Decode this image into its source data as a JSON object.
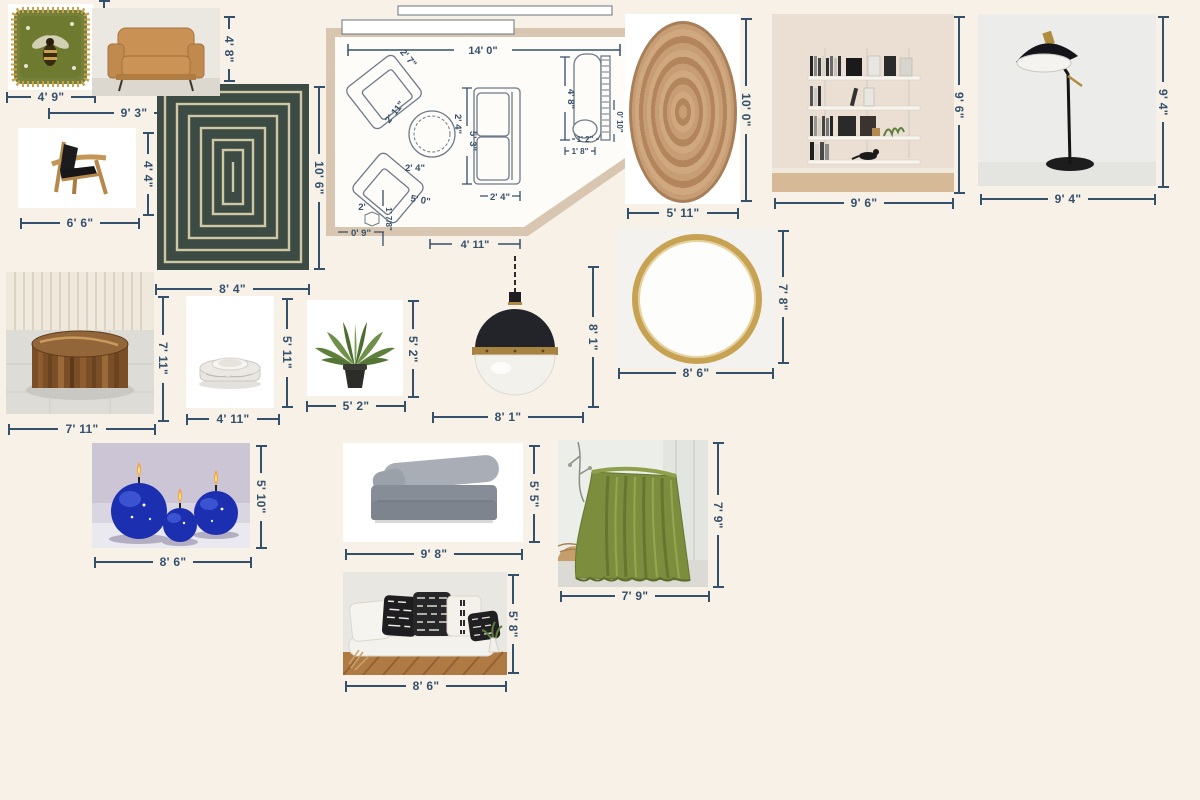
{
  "colors": {
    "background": "#f7f1e8",
    "dimension": "#35506b",
    "plan_wall": "#d8c6b1"
  },
  "items": {
    "bee_pillow": {
      "w": "4' 9\"",
      "h": "4' 9\""
    },
    "leather_armchair": {
      "w": "9' 3\"",
      "h": "4' 8\""
    },
    "sling_chair": {
      "w": "6' 6\"",
      "h": "4' 4\""
    },
    "green_rug": {
      "w": "8' 4\"",
      "h": "10' 6\""
    },
    "jute_rug": {
      "w": "5' 11\"",
      "h": "10' 0\""
    },
    "wall_shelf": {
      "w": "9' 6\"",
      "h": "9' 6\""
    },
    "floor_lamp": {
      "w": "9' 4\"",
      "h": "9' 4\""
    },
    "mirror": {
      "w": "8' 6\"",
      "h": "7' 8\""
    },
    "coffee_table": {
      "w": "7' 11\"",
      "h": "7' 11\""
    },
    "marble_bowl": {
      "w": "4' 11\"",
      "h": "5' 11\""
    },
    "plant": {
      "w": "5' 2\"",
      "h": "5' 2\""
    },
    "pendant": {
      "w": "8' 1\"",
      "h": "8' 1\""
    },
    "candles": {
      "w": "8' 6\"",
      "h": "5' 10\""
    },
    "sofa": {
      "w": "9' 8\"",
      "h": "5' 5\""
    },
    "pillow_bench": {
      "w": "8' 6\"",
      "h": "5' 8\""
    },
    "green_throw": {
      "w": "7' 9\"",
      "h": "7' 9\""
    }
  },
  "floor_plan": {
    "room_width": "14' 0\"",
    "wall_bottom": "4' 11\"",
    "chair_a": "2' 7\"",
    "table": "2' 11\"",
    "chair_b": "2' 4\"",
    "sofa_length": "5' 3\"",
    "sofa_depth": "2' 4\"",
    "sofa_width": "2' 4\"",
    "spacing": "5' 0\"",
    "side_table": "2'",
    "side_table_w": "0' 9\"",
    "side_table_h": "1' 7/8\"",
    "piano_length": "4' 8\"",
    "bench_depth": "1' 2\"",
    "bench_width": "1' 8\"",
    "piano_depth": "0' 10\""
  }
}
